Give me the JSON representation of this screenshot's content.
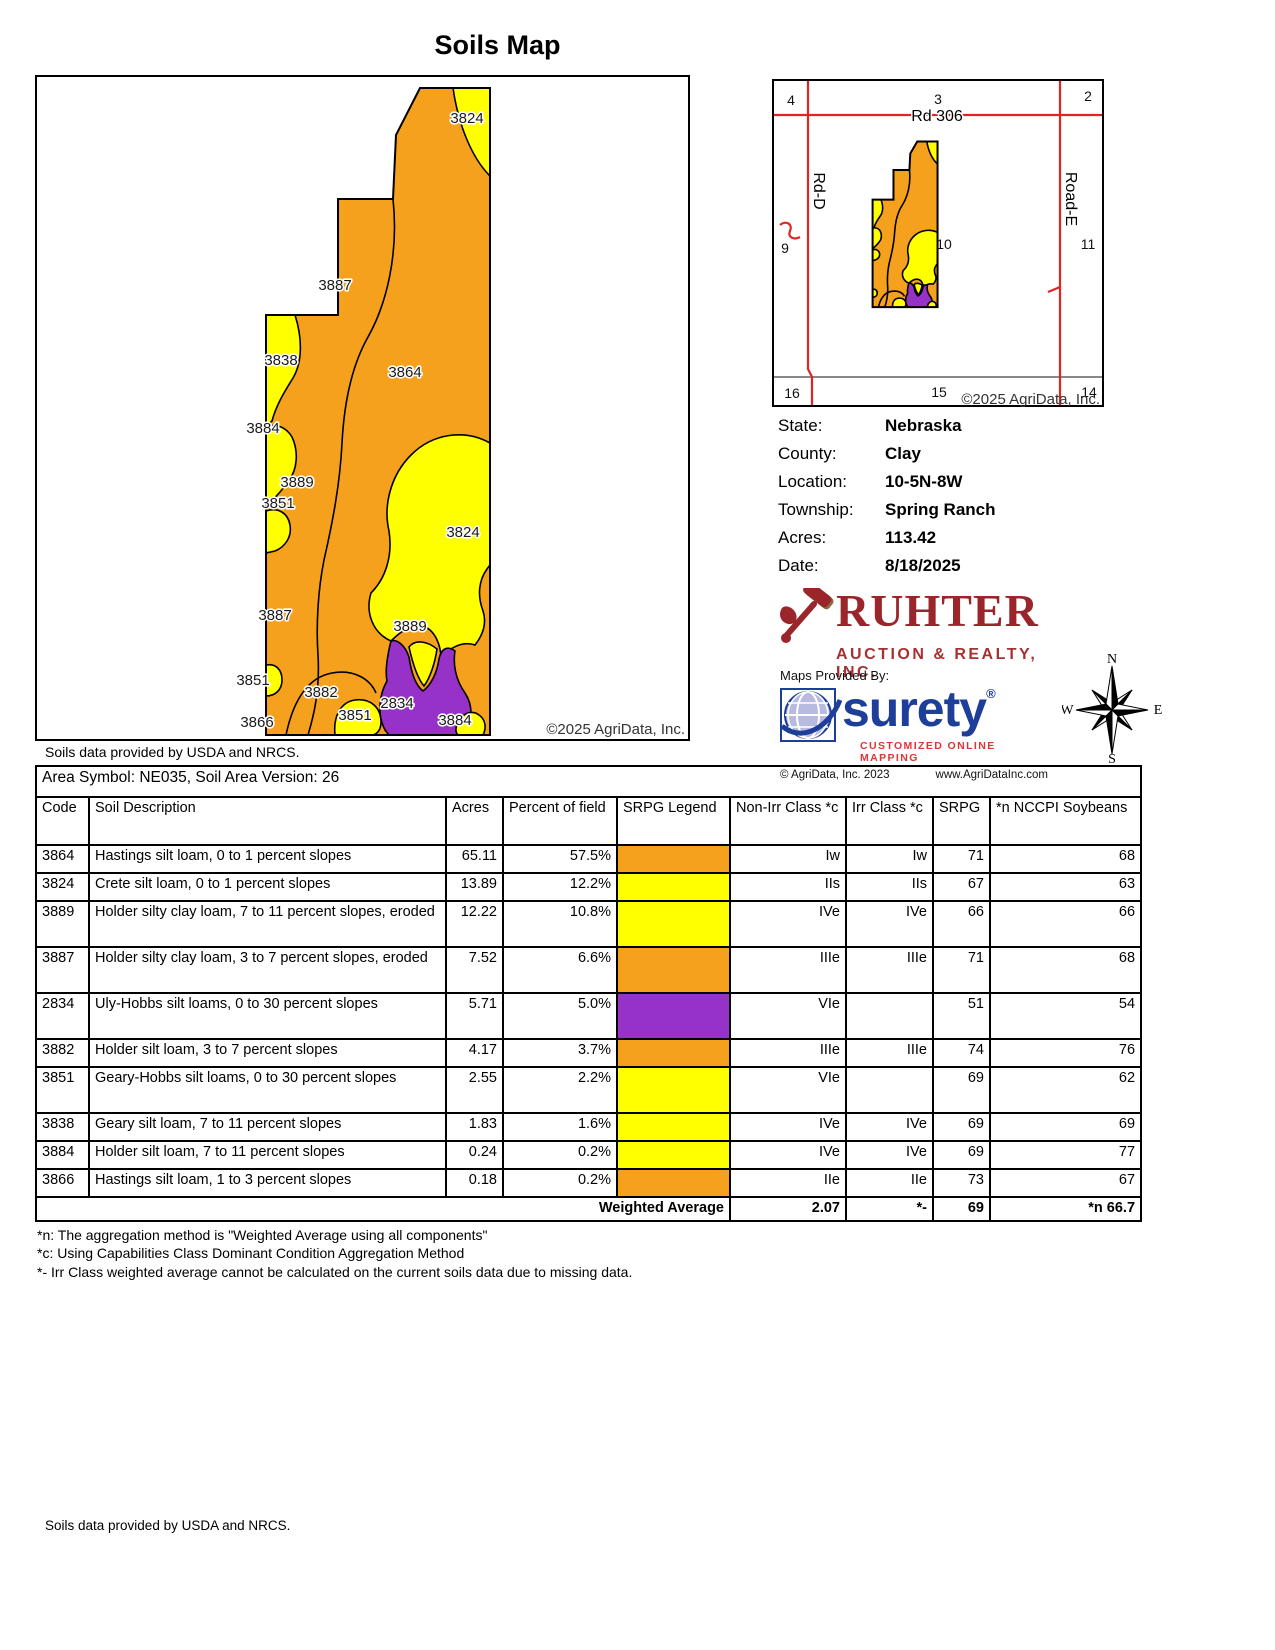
{
  "page": {
    "title": "Soils Map"
  },
  "map": {
    "labels": [
      "3824",
      "3887",
      "3838",
      "3864",
      "3884",
      "3889",
      "3851",
      "3824",
      "3887",
      "3889",
      "3851",
      "3882",
      "2834",
      "3851",
      "3866",
      "3884"
    ],
    "copyright": "©2025 AgriData, Inc.",
    "soils_credit": "Soils data provided by USDA and NRCS.",
    "colors": {
      "orange": "#F6A11D",
      "yellow": "#FFFF00",
      "purple": "#9732C8"
    }
  },
  "locator": {
    "sections": [
      "4",
      "3",
      "2",
      "9",
      "10",
      "11",
      "16",
      "15",
      "14"
    ],
    "roads": {
      "top": "Rd 306",
      "left": "Rd-D",
      "right": "Road-E"
    },
    "road_color": "#E02424",
    "copyright": "©2025 AgriData, Inc."
  },
  "info": {
    "rows": [
      {
        "label": "State:",
        "value": "Nebraska"
      },
      {
        "label": "County:",
        "value": "Clay"
      },
      {
        "label": "Location:",
        "value": "10-5N-8W"
      },
      {
        "label": "Township:",
        "value": "Spring Ranch"
      },
      {
        "label": "Acres:",
        "value": "113.42"
      },
      {
        "label": "Date:",
        "value": "8/18/2025"
      }
    ]
  },
  "branding": {
    "ruhter_name": "RUHTER",
    "ruhter_sub": "AUCTION & REALTY, INC.",
    "maps_provided": "Maps Provided By:",
    "surety": "surety",
    "surety_reg": "®",
    "surety_tag": "CUSTOMIZED ONLINE MAPPING",
    "surety_copy": "© AgriData, Inc. 2023",
    "surety_url": "www.AgriDataInc.com",
    "ruhter_color": "#9A252B",
    "surety_color": "#1D3F99",
    "compass": {
      "n": "N",
      "e": "E",
      "s": "S",
      "w": "W"
    }
  },
  "table": {
    "area_title": "Area Symbol: NE035, Soil Area Version: 26",
    "headers": [
      "Code",
      "Soil Description",
      "Acres",
      "Percent of field",
      "SRPG Legend",
      "Non-Irr Class *c",
      "Irr Class *c",
      "SRPG",
      "*n NCCPI Soybeans"
    ],
    "rows": [
      {
        "code": "3864",
        "description": "Hastings silt loam, 0 to 1 percent slopes",
        "acres": "65.11",
        "percent": "57.5%",
        "legend_color": "#F6A11D",
        "non_irr": "Iw",
        "irr": "Iw",
        "srpg": "71",
        "nccpi": "68"
      },
      {
        "code": "3824",
        "description": "Crete silt loam, 0 to 1 percent slopes",
        "acres": "13.89",
        "percent": "12.2%",
        "legend_color": "#FFFF00",
        "non_irr": "IIs",
        "irr": "IIs",
        "srpg": "67",
        "nccpi": "63"
      },
      {
        "code": "3889",
        "description": "Holder silty clay loam, 7 to 11 percent slopes, eroded",
        "acres": "12.22",
        "percent": "10.8%",
        "legend_color": "#FFFF00",
        "non_irr": "IVe",
        "irr": "IVe",
        "srpg": "66",
        "nccpi": "66"
      },
      {
        "code": "3887",
        "description": "Holder silty clay loam, 3 to 7 percent slopes, eroded",
        "acres": "7.52",
        "percent": "6.6%",
        "legend_color": "#F6A11D",
        "non_irr": "IIIe",
        "irr": "IIIe",
        "srpg": "71",
        "nccpi": "68"
      },
      {
        "code": "2834",
        "description": "Uly-Hobbs silt loams, 0 to 30 percent slopes",
        "acres": "5.71",
        "percent": "5.0%",
        "legend_color": "#9732C8",
        "non_irr": "VIe",
        "irr": "",
        "srpg": "51",
        "nccpi": "54"
      },
      {
        "code": "3882",
        "description": "Holder silt loam, 3 to 7 percent slopes",
        "acres": "4.17",
        "percent": "3.7%",
        "legend_color": "#F6A11D",
        "non_irr": "IIIe",
        "irr": "IIIe",
        "srpg": "74",
        "nccpi": "76"
      },
      {
        "code": "3851",
        "description": "Geary-Hobbs silt loams, 0 to 30 percent slopes",
        "acres": "2.55",
        "percent": "2.2%",
        "legend_color": "#FFFF00",
        "non_irr": "VIe",
        "irr": "",
        "srpg": "69",
        "nccpi": "62"
      },
      {
        "code": "3838",
        "description": "Geary silt loam, 7 to 11 percent slopes",
        "acres": "1.83",
        "percent": "1.6%",
        "legend_color": "#FFFF00",
        "non_irr": "IVe",
        "irr": "IVe",
        "srpg": "69",
        "nccpi": "69"
      },
      {
        "code": "3884",
        "description": "Holder silt loam, 7 to 11 percent slopes",
        "acres": "0.24",
        "percent": "0.2%",
        "legend_color": "#FFFF00",
        "non_irr": "IVe",
        "irr": "IVe",
        "srpg": "69",
        "nccpi": "77"
      },
      {
        "code": "3866",
        "description": "Hastings silt loam, 1 to 3 percent slopes",
        "acres": "0.18",
        "percent": "0.2%",
        "legend_color": "#F6A11D",
        "non_irr": "IIe",
        "irr": "IIe",
        "srpg": "73",
        "nccpi": "67"
      }
    ],
    "weighted": {
      "label": "Weighted Average",
      "non_irr": "2.07",
      "irr": "*-",
      "srpg": "69",
      "nccpi": "*n 66.7"
    }
  },
  "footnotes": [
    "*n: The aggregation method is \"Weighted Average using all components\"",
    "*c: Using Capabilities Class Dominant Condition Aggregation Method",
    "*- Irr Class weighted average cannot be calculated on the current soils data due to missing data."
  ],
  "footer": "Soils data provided by USDA and NRCS."
}
